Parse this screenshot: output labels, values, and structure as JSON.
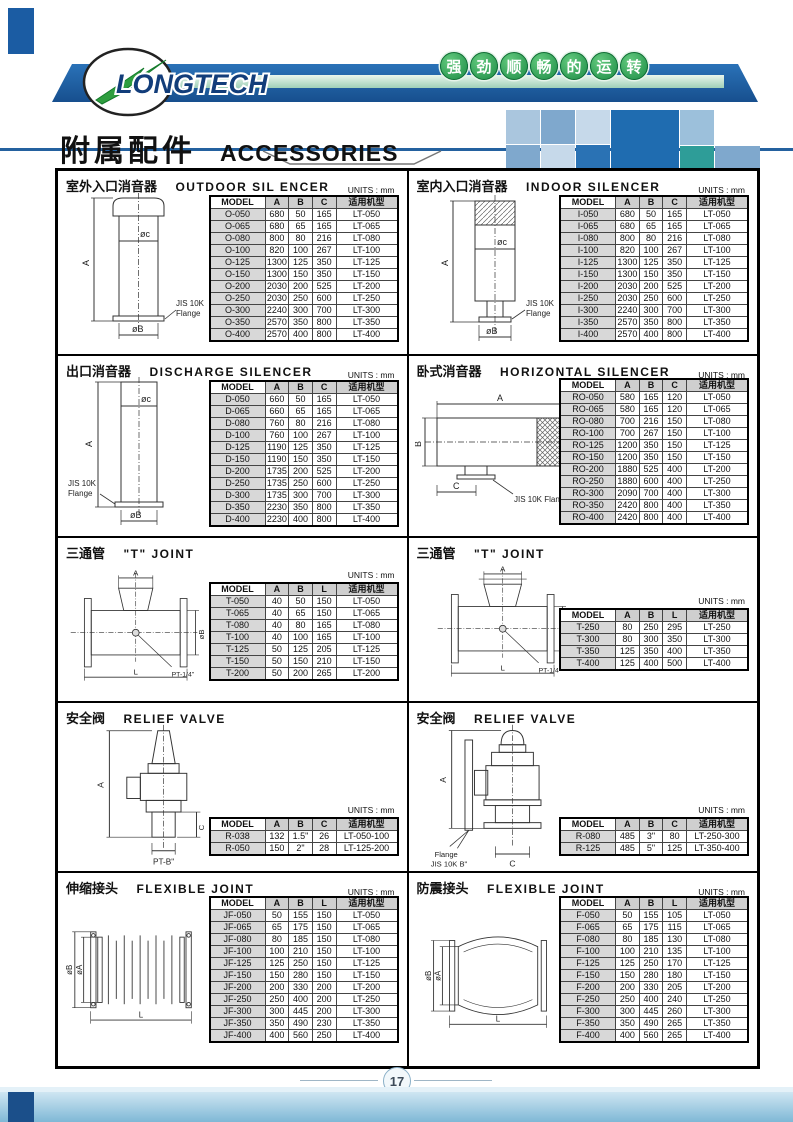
{
  "page": {
    "brand": "LONGTECH",
    "slogan_chars": [
      "强",
      "劲",
      "顺",
      "畅",
      "的",
      "运",
      "转"
    ],
    "title_zh": "附属配件",
    "title_en": "ACCESSORIES",
    "units_label": "UNITS : mm",
    "page_number": "17",
    "colors": {
      "brand_navy": "#1b5ca3",
      "slogan_green": "#1e8c46",
      "table_header_gray": "#cfcfcf"
    }
  },
  "sections": [
    {
      "id": "outdoor-silencer",
      "title_zh": "室外入口消音器",
      "title_en": "OUTDOOR SIL ENCER",
      "columns": [
        "MODEL",
        "A",
        "B",
        "C",
        "适用机型"
      ],
      "rows": [
        [
          "O-050",
          "680",
          "50",
          "165",
          "LT-050"
        ],
        [
          "O-065",
          "680",
          "65",
          "165",
          "LT-065"
        ],
        [
          "O-080",
          "800",
          "80",
          "216",
          "LT-080"
        ],
        [
          "O-100",
          "820",
          "100",
          "267",
          "LT-100"
        ],
        [
          "O-125",
          "1300",
          "125",
          "350",
          "LT-125"
        ],
        [
          "O-150",
          "1300",
          "150",
          "350",
          "LT-150"
        ],
        [
          "O-200",
          "2030",
          "200",
          "525",
          "LT-200"
        ],
        [
          "O-250",
          "2030",
          "250",
          "600",
          "LT-250"
        ],
        [
          "O-300",
          "2240",
          "300",
          "700",
          "LT-300"
        ],
        [
          "O-350",
          "2570",
          "350",
          "800",
          "LT-350"
        ],
        [
          "O-400",
          "2570",
          "400",
          "800",
          "LT-400"
        ]
      ],
      "diagram": {
        "a": "A",
        "c": "øc",
        "b": "øB",
        "flange1": "JIS 10K",
        "flange2": "Flange"
      }
    },
    {
      "id": "indoor-silencer",
      "title_zh": "室内入口消音器",
      "title_en": "INDOOR SILENCER",
      "columns": [
        "MODEL",
        "A",
        "B",
        "C",
        "适用机型"
      ],
      "rows": [
        [
          "I-050",
          "680",
          "50",
          "165",
          "LT-050"
        ],
        [
          "I-065",
          "680",
          "65",
          "165",
          "LT-065"
        ],
        [
          "I-080",
          "800",
          "80",
          "216",
          "LT-080"
        ],
        [
          "I-100",
          "820",
          "100",
          "267",
          "LT-100"
        ],
        [
          "I-125",
          "1300",
          "125",
          "350",
          "LT-125"
        ],
        [
          "I-150",
          "1300",
          "150",
          "350",
          "LT-150"
        ],
        [
          "I-200",
          "2030",
          "200",
          "525",
          "LT-200"
        ],
        [
          "I-250",
          "2030",
          "250",
          "600",
          "LT-250"
        ],
        [
          "I-300",
          "2240",
          "300",
          "700",
          "LT-300"
        ],
        [
          "I-350",
          "2570",
          "350",
          "800",
          "LT-350"
        ],
        [
          "I-400",
          "2570",
          "400",
          "800",
          "LT-400"
        ]
      ],
      "diagram": {
        "a": "A",
        "c": "øc",
        "b": "øB",
        "flange1": "JIS 10K",
        "flange2": "Flange"
      }
    },
    {
      "id": "discharge-silencer",
      "title_zh": "出口消音器",
      "title_en": "DISCHARGE SILENCER",
      "columns": [
        "MODEL",
        "A",
        "B",
        "C",
        "适用机型"
      ],
      "rows": [
        [
          "D-050",
          "660",
          "50",
          "165",
          "LT-050"
        ],
        [
          "D-065",
          "660",
          "65",
          "165",
          "LT-065"
        ],
        [
          "D-080",
          "760",
          "80",
          "216",
          "LT-080"
        ],
        [
          "D-100",
          "760",
          "100",
          "267",
          "LT-100"
        ],
        [
          "D-125",
          "1190",
          "125",
          "350",
          "LT-125"
        ],
        [
          "D-150",
          "1190",
          "150",
          "350",
          "LT-150"
        ],
        [
          "D-200",
          "1735",
          "200",
          "525",
          "LT-200"
        ],
        [
          "D-250",
          "1735",
          "250",
          "600",
          "LT-250"
        ],
        [
          "D-300",
          "1735",
          "300",
          "700",
          "LT-300"
        ],
        [
          "D-350",
          "2230",
          "350",
          "800",
          "LT-350"
        ],
        [
          "D-400",
          "2230",
          "400",
          "800",
          "LT-400"
        ]
      ],
      "diagram": {
        "a": "A",
        "c": "øc",
        "b": "øB",
        "flange1": "JIS 10K",
        "flange2": "Flange"
      }
    },
    {
      "id": "horizontal-silencer",
      "title_zh": "卧式消音器",
      "title_en": "HORIZONTAL SILENCER",
      "columns": [
        "MODEL",
        "A",
        "B",
        "C",
        "适用机型"
      ],
      "rows": [
        [
          "RO-050",
          "580",
          "165",
          "120",
          "LT-050"
        ],
        [
          "RO-065",
          "580",
          "165",
          "120",
          "LT-065"
        ],
        [
          "RO-080",
          "700",
          "216",
          "150",
          "LT-080"
        ],
        [
          "RO-100",
          "700",
          "267",
          "150",
          "LT-100"
        ],
        [
          "RO-125",
          "1200",
          "350",
          "150",
          "LT-125"
        ],
        [
          "RO-150",
          "1200",
          "350",
          "150",
          "LT-150"
        ],
        [
          "RO-200",
          "1880",
          "525",
          "400",
          "LT-200"
        ],
        [
          "RO-250",
          "1880",
          "600",
          "400",
          "LT-250"
        ],
        [
          "RO-300",
          "2090",
          "700",
          "400",
          "LT-300"
        ],
        [
          "RO-350",
          "2420",
          "800",
          "400",
          "LT-350"
        ],
        [
          "RO-400",
          "2420",
          "800",
          "400",
          "LT-400"
        ]
      ],
      "diagram": {
        "a": "A",
        "b": "B",
        "c": "C",
        "flange1": "JIS 10K Flange"
      }
    },
    {
      "id": "t-joint-small",
      "title_zh": "三通管",
      "title_en": "\"T\" JOINT",
      "columns": [
        "MODEL",
        "A",
        "B",
        "L",
        "适用机型"
      ],
      "rows": [
        [
          "T-050",
          "40",
          "50",
          "150",
          "LT-050"
        ],
        [
          "T-065",
          "40",
          "65",
          "150",
          "LT-065"
        ],
        [
          "T-080",
          "40",
          "80",
          "165",
          "LT-080"
        ],
        [
          "T-100",
          "40",
          "100",
          "165",
          "LT-100"
        ],
        [
          "T-125",
          "50",
          "125",
          "205",
          "LT-125"
        ],
        [
          "T-150",
          "50",
          "150",
          "210",
          "LT-150"
        ],
        [
          "T-200",
          "50",
          "200",
          "265",
          "LT-200"
        ]
      ],
      "diagram": {
        "a": "A",
        "b": "øB",
        "l": "L",
        "port": "PT-1/4\""
      }
    },
    {
      "id": "t-joint-large",
      "title_zh": "三通管",
      "title_en": "\"T\" JOINT",
      "columns": [
        "MODEL",
        "A",
        "B",
        "L",
        "适用机型"
      ],
      "rows": [
        [
          "T-250",
          "80",
          "250",
          "295",
          "LT-250"
        ],
        [
          "T-300",
          "80",
          "300",
          "350",
          "LT-300"
        ],
        [
          "T-350",
          "125",
          "350",
          "400",
          "LT-350"
        ],
        [
          "T-400",
          "125",
          "400",
          "500",
          "LT-400"
        ]
      ],
      "diagram": {
        "a": "A",
        "b": "øB",
        "l": "L",
        "port": "PT-1/4\""
      }
    },
    {
      "id": "relief-valve-small",
      "title_zh": "安全阀",
      "title_en": "RELIEF VALVE",
      "columns": [
        "MODEL",
        "A",
        "B",
        "C",
        "适用机型"
      ],
      "rows": [
        [
          "R-038",
          "132",
          "1.5\"",
          "26",
          "LT-050-100"
        ],
        [
          "R-050",
          "150",
          "2\"",
          "28",
          "LT-125-200"
        ]
      ],
      "diagram": {
        "a": "A",
        "c": "C",
        "port": "PT-B\""
      }
    },
    {
      "id": "relief-valve-large",
      "title_zh": "安全阀",
      "title_en": "RELIEF VALVE",
      "columns": [
        "MODEL",
        "A",
        "B",
        "C",
        "适用机型"
      ],
      "rows": [
        [
          "R-080",
          "485",
          "3\"",
          "80",
          "LT-250-300"
        ],
        [
          "R-125",
          "485",
          "5\"",
          "125",
          "LT-350-400"
        ]
      ],
      "diagram": {
        "a": "A",
        "c": "C",
        "flange1": "Flange",
        "flange2": "JIS 10K B\""
      }
    },
    {
      "id": "flexible-joint",
      "title_zh": "伸缩接头",
      "title_en": "FLEXIBLE JOINT",
      "columns": [
        "MODEL",
        "A",
        "B",
        "L",
        "适用机型"
      ],
      "rows": [
        [
          "JF-050",
          "50",
          "155",
          "150",
          "LT-050"
        ],
        [
          "JF-065",
          "65",
          "175",
          "150",
          "LT-065"
        ],
        [
          "JF-080",
          "80",
          "185",
          "150",
          "LT-080"
        ],
        [
          "JF-100",
          "100",
          "210",
          "150",
          "LT-100"
        ],
        [
          "JF-125",
          "125",
          "250",
          "150",
          "LT-125"
        ],
        [
          "JF-150",
          "150",
          "280",
          "150",
          "LT-150"
        ],
        [
          "JF-200",
          "200",
          "330",
          "200",
          "LT-200"
        ],
        [
          "JF-250",
          "250",
          "400",
          "200",
          "LT-250"
        ],
        [
          "JF-300",
          "300",
          "445",
          "200",
          "LT-300"
        ],
        [
          "JF-350",
          "350",
          "490",
          "230",
          "LT-350"
        ],
        [
          "JF-400",
          "400",
          "560",
          "250",
          "LT-400"
        ]
      ],
      "diagram": {
        "a": "øA",
        "b": "øB",
        "l": "L"
      }
    },
    {
      "id": "anti-vibration-joint",
      "title_zh": "防震接头",
      "title_en": "FLEXIBLE JOINT",
      "columns": [
        "MODEL",
        "A",
        "B",
        "L",
        "适用机型"
      ],
      "rows": [
        [
          "F-050",
          "50",
          "155",
          "105",
          "LT-050"
        ],
        [
          "F-065",
          "65",
          "175",
          "115",
          "LT-065"
        ],
        [
          "F-080",
          "80",
          "185",
          "130",
          "LT-080"
        ],
        [
          "F-100",
          "100",
          "210",
          "135",
          "LT-100"
        ],
        [
          "F-125",
          "125",
          "250",
          "170",
          "LT-125"
        ],
        [
          "F-150",
          "150",
          "280",
          "180",
          "LT-150"
        ],
        [
          "F-200",
          "200",
          "330",
          "205",
          "LT-200"
        ],
        [
          "F-250",
          "250",
          "400",
          "240",
          "LT-250"
        ],
        [
          "F-300",
          "300",
          "445",
          "260",
          "LT-300"
        ],
        [
          "F-350",
          "350",
          "490",
          "265",
          "LT-350"
        ],
        [
          "F-400",
          "400",
          "560",
          "265",
          "LT-400"
        ]
      ],
      "diagram": {
        "a": "øA",
        "b": "øB",
        "l": "L"
      }
    }
  ]
}
